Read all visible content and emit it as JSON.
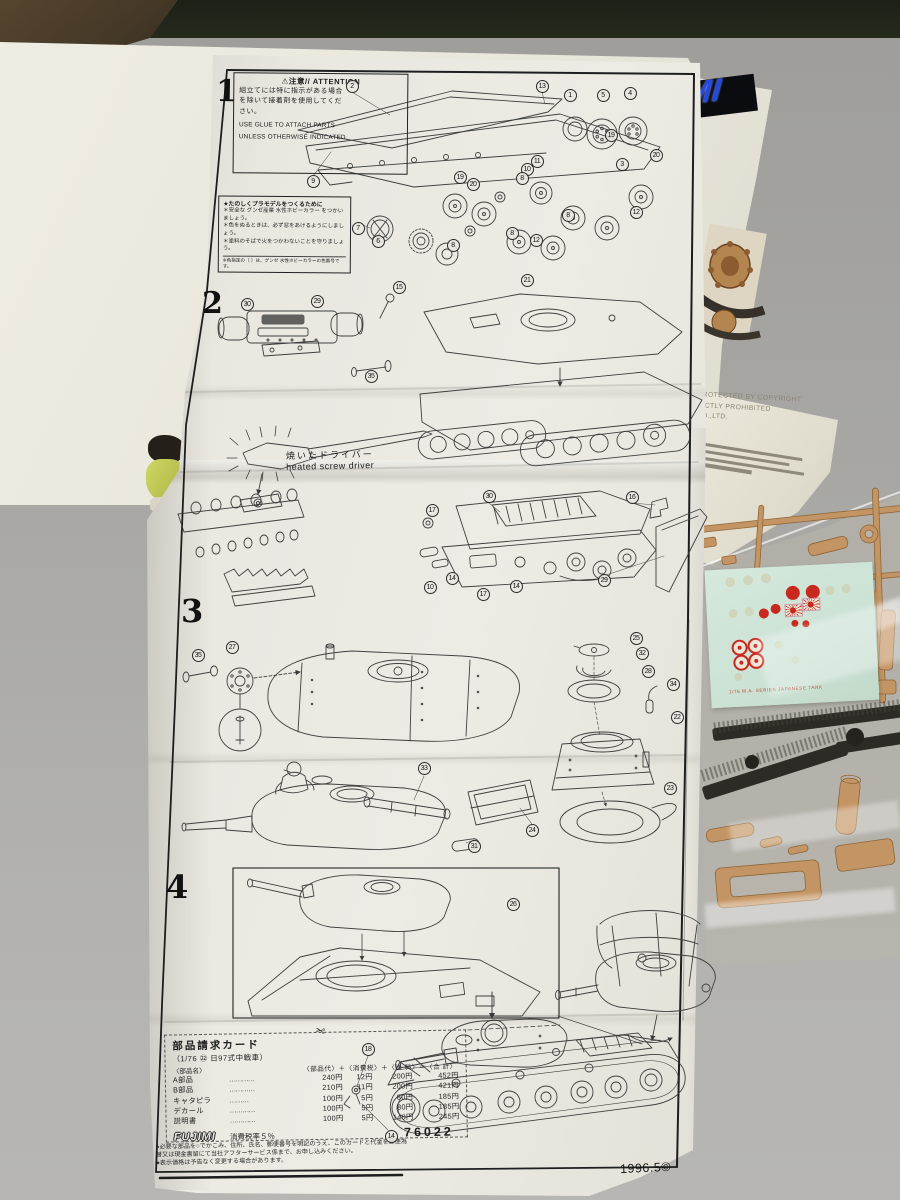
{
  "sheet": {
    "attention": {
      "title": "⚠注意// ATTENTION",
      "jp": [
        "組立てには特に指示がある場合",
        "を除いて接着剤を使用してくだ",
        "さい。"
      ],
      "en": [
        "USE GLUE TO ATTACH PARTS",
        "UNLESS OTHERWISE INDICATED."
      ]
    },
    "tips": {
      "heading": "★たのしくプラモデルをつくるために",
      "bullets": [
        "＊安全な グンゼ産業 水性ホビーカラー をつかいましょう。",
        "＊色をぬるときは、必ず窓をあけるようにしましょう。",
        "＊塗料のそばで火をつかわないことを守りましょう。"
      ],
      "footnote": "※色指定の〔 〕は、グンゼ 水性ホビーカラーの色番号です。"
    },
    "steps": [
      "1",
      "2",
      "3",
      "4"
    ],
    "screwdriver": {
      "jp": "焼いたドライバー",
      "en": "heated screw driver"
    },
    "callouts": {
      "step1": [
        "2",
        "13",
        "1",
        "5",
        "4",
        "19",
        "20",
        "3",
        "11",
        "10",
        "9",
        "19",
        "20",
        "8",
        "8",
        "12",
        "8",
        "12",
        "7",
        "6",
        "8"
      ],
      "step2": [
        "30",
        "29",
        "15",
        "35",
        "21"
      ],
      "step3a": [
        "30",
        "16",
        "17",
        "14",
        "10",
        "17",
        "14",
        "29"
      ],
      "step3b": [
        "35",
        "27",
        "25",
        "32",
        "28",
        "34",
        "22",
        "23",
        "33",
        "31",
        "24"
      ],
      "step4": [
        "26",
        "18",
        "14"
      ]
    },
    "parts_card": {
      "scissors_icon": "✂",
      "title": "部品請求カード",
      "subtitle": "（1/76 ㉒ 日97式中戦車）",
      "name_header": "〈部品名〉",
      "price_header": "〈部品代〉＋〈消費税〉＋〈送 料〉＝〈合 計〉",
      "rows": [
        {
          "name": "A部品",
          "dots": "…………",
          "parts": "240円",
          "tax": "12円",
          "ship": "200円",
          "total": "452円"
        },
        {
          "name": "B部品",
          "dots": "…………",
          "parts": "210円",
          "tax": "11円",
          "ship": "200円",
          "total": "421円"
        },
        {
          "name": "キャタピラ",
          "dots": "………",
          "parts": "100円",
          "tax": "5円",
          "ship": "80円",
          "total": "185円"
        },
        {
          "name": "デカール",
          "dots": "…………",
          "parts": "100円",
          "tax": "5円",
          "ship": "80円",
          "total": "185円"
        },
        {
          "name": "説明書",
          "dots": "…………",
          "parts": "100円",
          "tax": "5円",
          "ship": "140円",
          "total": "245円"
        }
      ],
      "logo": "FUJIMI",
      "tax_note": "消費税率５％",
      "kit_no": "76022"
    },
    "fine_print": [
      "●必要な部品を○でかこみ、住所、氏名、郵便番号を明記のうえ、このカードと代金を郵便為替又は現金書留にて当社アフターサービス係まで、お申し込みください。",
      "●表示価格は予告なく変更する場合があります。"
    ],
    "copyright": "1996.5©"
  },
  "box": {
    "side_lines": [
      "PROTECTED BY COPYRIGHT",
      "RICTLY PROHIBITED",
      "CO.,LTD."
    ],
    "logo_partial": "MI"
  },
  "decal": {
    "caption": "1/76 M.A. SERIES JAPANESE TANK"
  },
  "colors": {
    "paper": "#eceae3",
    "box": "#e9e6dc",
    "sprue_tan": "#c49564",
    "track_black": "#2e2b26",
    "decal_mint": "#cde3d5",
    "decal_red": "#c8281e",
    "logo_blue": "#2449e0"
  }
}
